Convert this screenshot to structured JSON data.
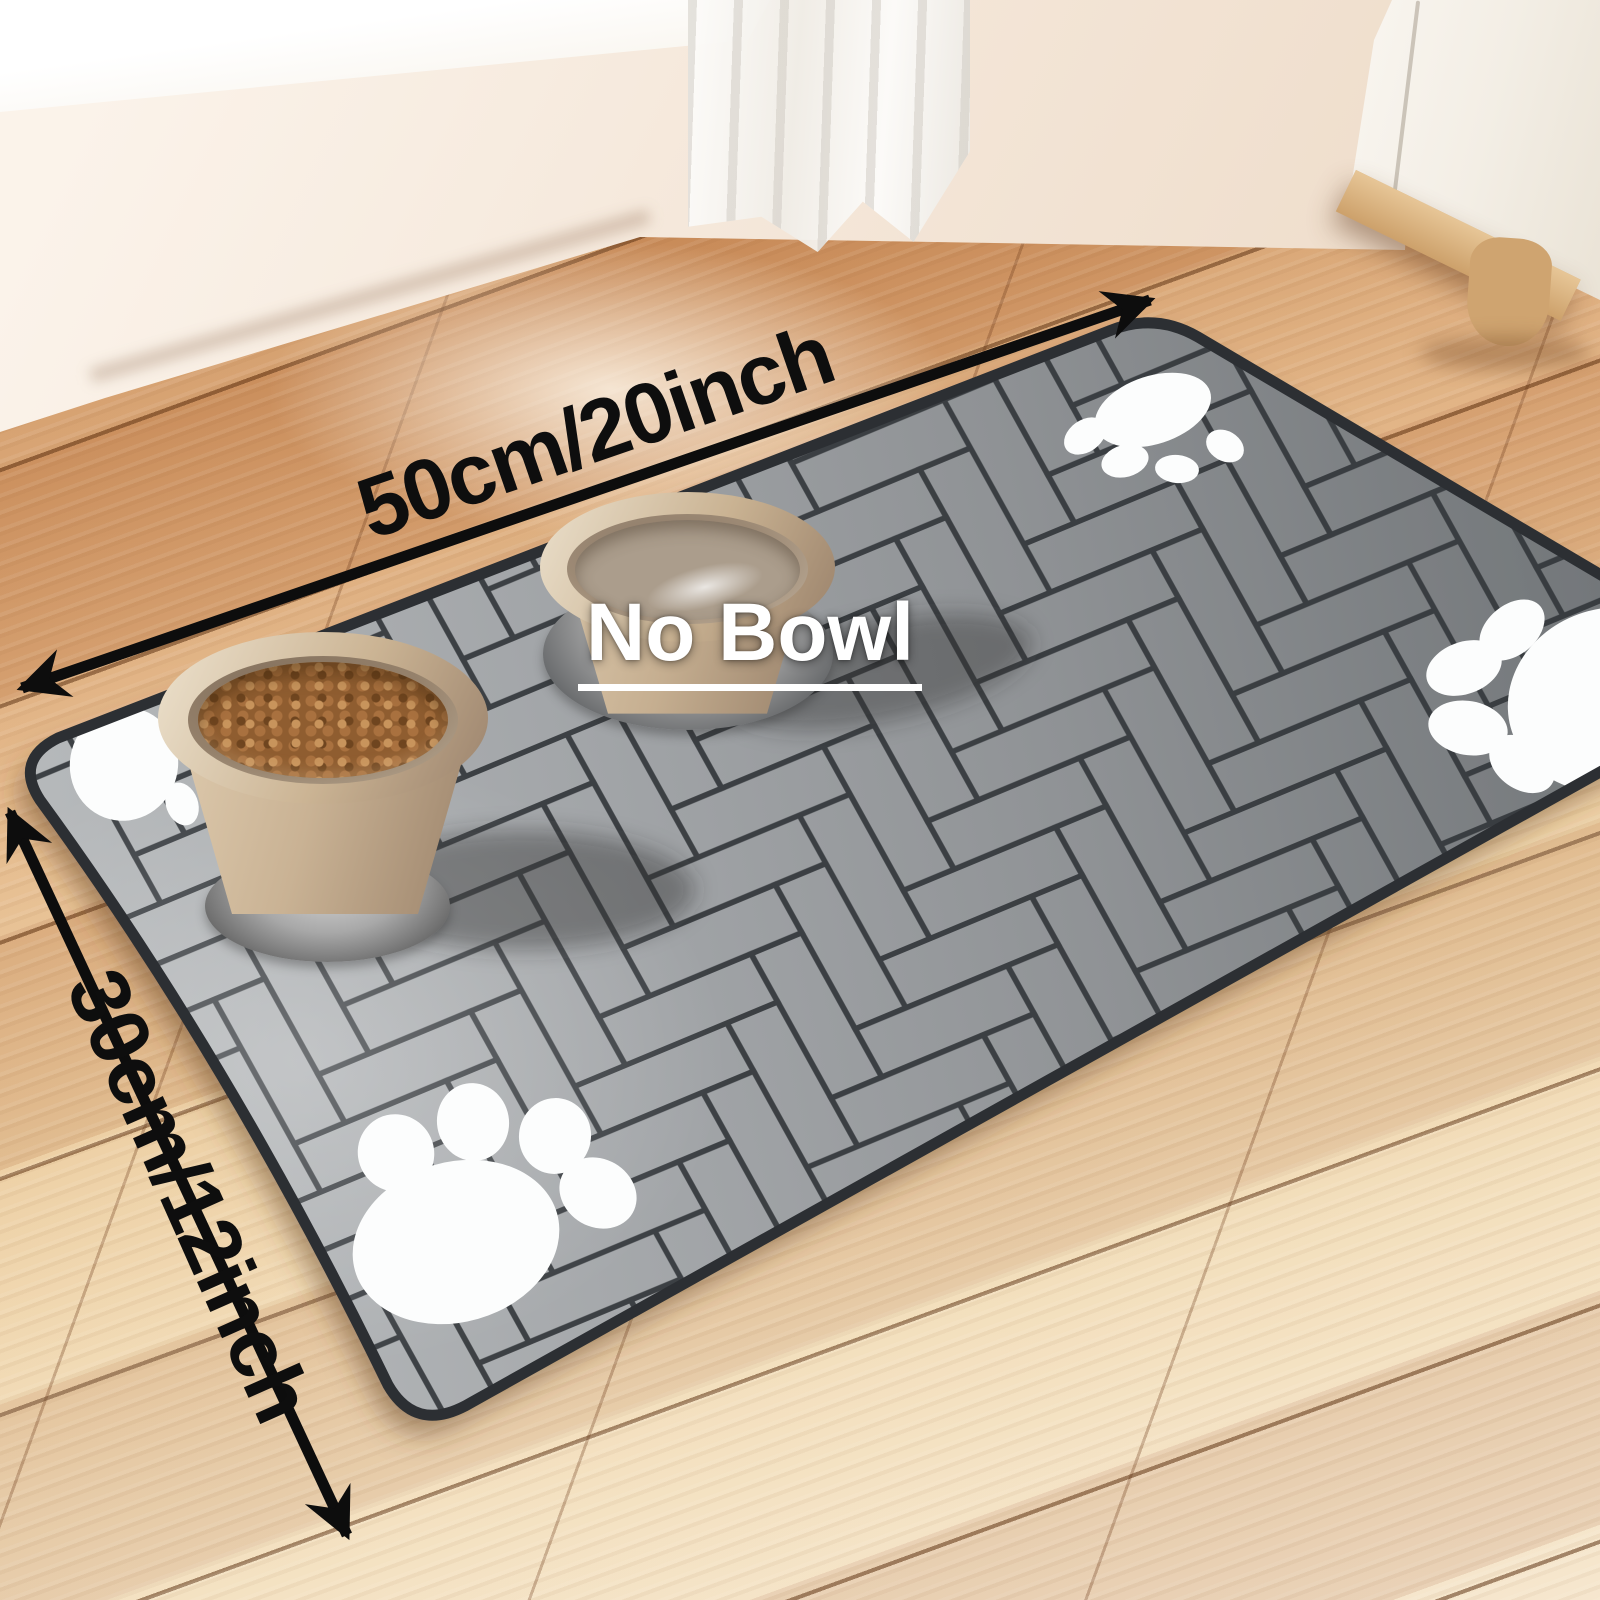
{
  "image": {
    "kind": "product photo",
    "subject": "gray herringbone pet feeding mat with food bowl and water bowl on wooden floor"
  },
  "annotations": {
    "width_label": "50cm/20inch",
    "height_label": "30cm/12inch",
    "center_label": "No Bowl"
  },
  "counts": {
    "bowls": 2,
    "paw_prints": 4
  },
  "colors": {
    "arrow_black": "#0d0d0d",
    "label_black": "#0e0e0e",
    "label_white": "#ffffff",
    "mat_gray_light": "#b4b7b9",
    "mat_gray_dark": "#74787b",
    "mat_seam": "#33373b",
    "mat_edge": "#2c2f33",
    "paw_white": "#fcfdfd",
    "floor_wood_warm": "#cd9160",
    "floor_wood_pale": "#f5e9d2",
    "wall_cream": "#f4e6d8",
    "bowl_beige": "#cbb69a",
    "kibble_brown": "#9c6a3a"
  }
}
